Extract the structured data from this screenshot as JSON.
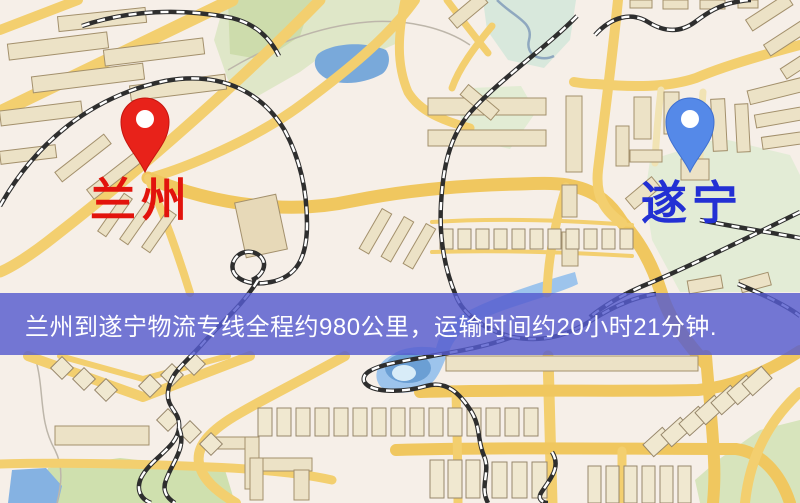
{
  "banner": {
    "text": "兰州到遂宁物流专线全程约980公里，运输时间约20小时21分钟.",
    "background_color": "#565bce",
    "text_color": "#ffffff"
  },
  "map": {
    "origin": {
      "label": "兰州",
      "label_color": "#e2130c",
      "pin_color": "#e8221a",
      "pin_style": "red-marker"
    },
    "destination": {
      "label": "遂宁",
      "label_color": "#2330d4",
      "pin_color": "#5589e8",
      "pin_style": "blue-marker"
    },
    "features": {
      "background_color": "#f4efe7",
      "road_color": "#f3cf6f",
      "park_color": "#dfe7c8",
      "water_color": "#79a9da",
      "railway_color": "#2e2e2e",
      "building_color": "#ece2c6"
    }
  },
  "route": {
    "origin": "兰州",
    "destination": "遂宁",
    "service_type": "物流专线",
    "distance_text": "约980公里",
    "duration_text": "约20小时21分钟"
  }
}
